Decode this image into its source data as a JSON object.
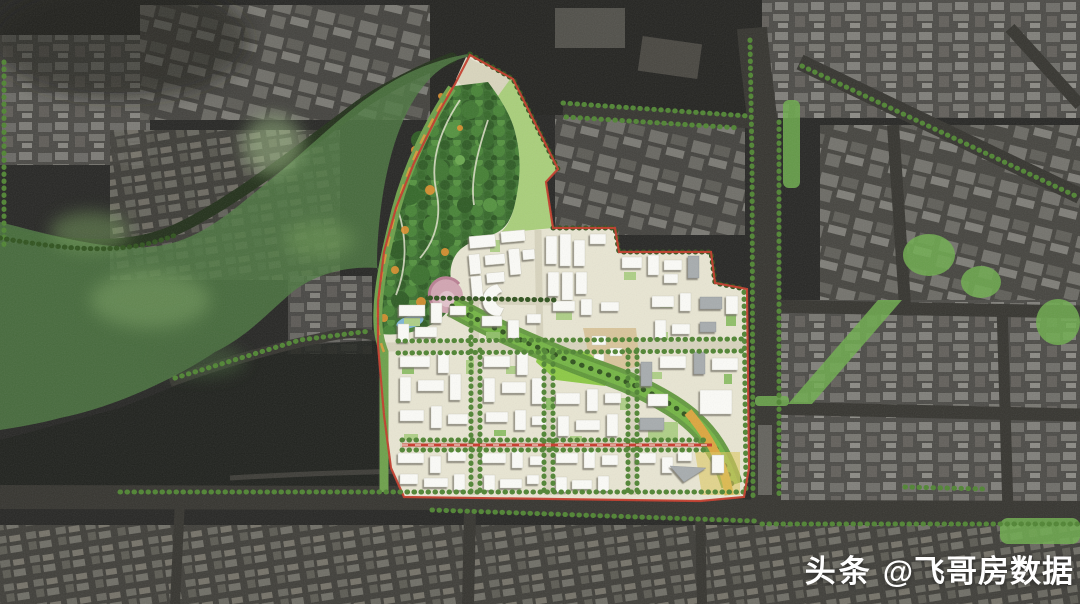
{
  "watermark": {
    "brand": "头条",
    "handle": "@飞哥房数据",
    "text_color": "#ffffff"
  },
  "palette": {
    "satellite_base": "#262624",
    "satellite_block_gray": "#7a7a76",
    "road_dark": "#35342f",
    "park_overlay_green": "#4e7a42",
    "highlight_green": "#6fae4e",
    "plan_ground_beige": "#e9e6d3",
    "forest_canopy_green": "#3c7030",
    "lawn_green": "#8cc944",
    "corridor_green": "#74b544",
    "building_white": "#fcfcf8",
    "building_gray": "#a7acae",
    "boundary_red": "#c43b2a",
    "road_orange": "#dca63e",
    "pond_blue": "#7fb7d6",
    "garden_pink": "#d2a5b2",
    "street_tree_green": "#4f8432",
    "tan_block": "#d9c59b"
  }
}
